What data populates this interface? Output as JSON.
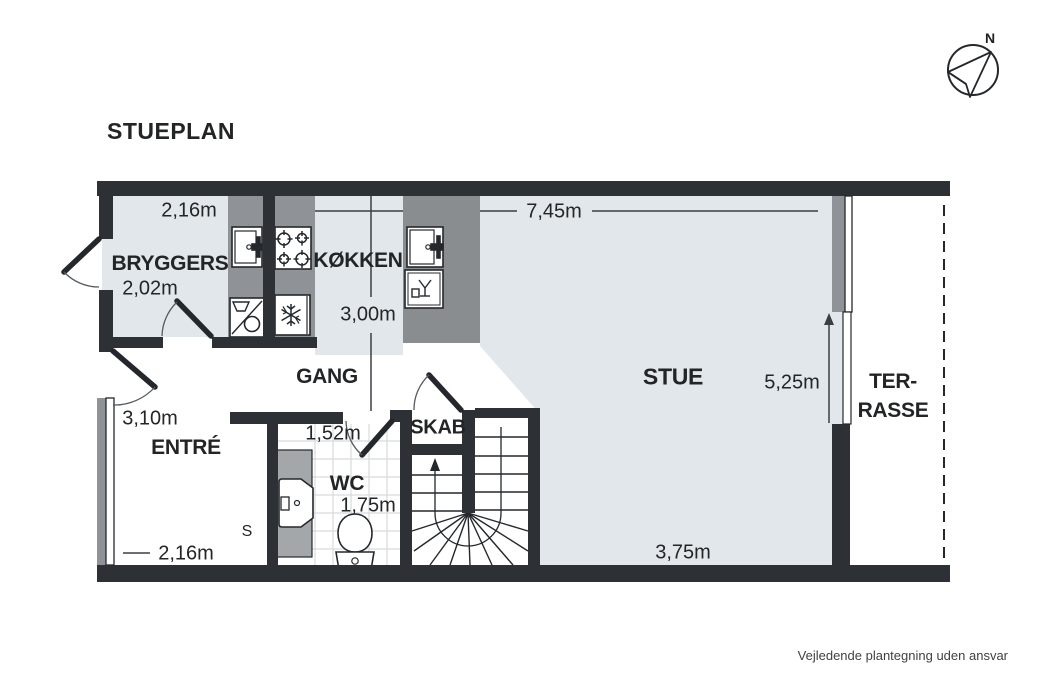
{
  "title": "STUEPLAN",
  "compass": {
    "north_label": "N"
  },
  "rooms": {
    "bryggers": {
      "label": "BRYGGERS",
      "width": "2,16m",
      "depth": "2,02m"
    },
    "kokken": {
      "label": "KØKKEN",
      "depth": "3,00m"
    },
    "gang": {
      "label": "GANG"
    },
    "entre": {
      "label": "ENTRÉ",
      "width": "3,10m",
      "bottom_width": "2,16m"
    },
    "wc": {
      "label": "WC",
      "width": "1,52m",
      "depth": "1,75m"
    },
    "skab": {
      "label": "SKAB"
    },
    "stue": {
      "label": "STUE",
      "width": "7,45m",
      "depth": "5,25m",
      "bottom_width": "3,75m"
    },
    "terrasse": {
      "label_line1": "TER-",
      "label_line2": "RASSE"
    },
    "wardrobe": {
      "label": "S"
    }
  },
  "icons": {
    "fixtures": [
      "sink-icon",
      "stove-icon",
      "washing-machine-icon",
      "freezer-icon",
      "kitchen-sink-icon",
      "dishwasher-icon",
      "wc-sink-icon",
      "toilet-icon",
      "stairs-icon",
      "compass-icon",
      "wardrobe-icon"
    ]
  },
  "colors": {
    "wall": "#2d3136",
    "floor": "#e2e7eb",
    "counter": "#8f9296",
    "island": "#8a8d90",
    "vanity": "#a3a7aa",
    "tile_line": "#d7dbde",
    "text": "#232527"
  },
  "footer": {
    "disclaimer": "Vejledende plantegning uden ansvar"
  }
}
